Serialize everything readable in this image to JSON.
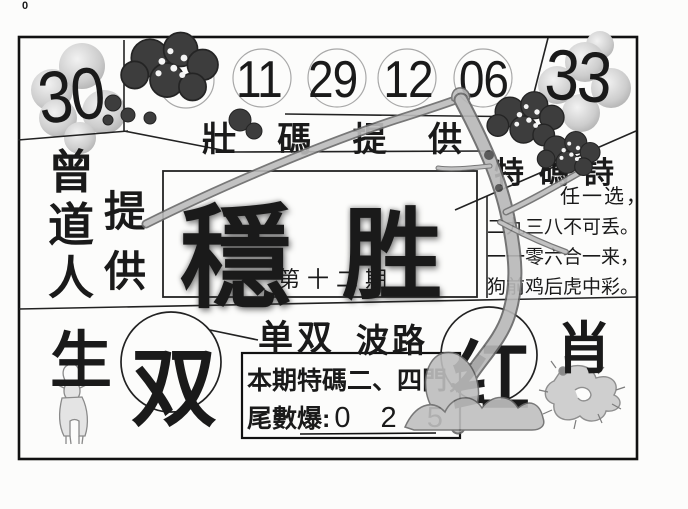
{
  "page": {
    "corner_mark": "0"
  },
  "colors": {
    "ink": "#1a1a1a",
    "branch_fill": "#b8b8b8",
    "branch_outline": "#6a6a6a",
    "blossom": "#3d3d3d",
    "ball_shade": "#c9c9c9",
    "circle_stroke": "#a8a8a8"
  },
  "header": {
    "left_number": "30",
    "right_number": "33",
    "special_numbers": [
      "11",
      "29",
      "12",
      "06"
    ],
    "band_chars": [
      "壯",
      "碼",
      "提",
      "供"
    ]
  },
  "left_panel": {
    "name_chars": [
      "曾",
      "道",
      "人"
    ],
    "provide_chars": [
      "提",
      "供"
    ]
  },
  "center": {
    "title_chars": [
      "穩",
      "胜"
    ],
    "issue_label": "第十二期"
  },
  "right_panel": {
    "title": "特碼詩",
    "lines": [
      "任一选，",
      "二九三八不可丢。",
      "一一零六合一来，",
      "狗前鸡后虎中彩。"
    ]
  },
  "bottom": {
    "life_char": "生",
    "even_char": "双",
    "odd_even_label": "单双",
    "wave_label": "波路",
    "tip_line1": "本期特碼二、四門，",
    "tip_line2_label": "尾數爆:",
    "tip_digits": "0 2 5",
    "red_char": "红",
    "zodiac_char": "肖"
  },
  "illustrations": {
    "top_left": "plum-blossom-cluster",
    "top_right": "plum-blossom-cluster",
    "left_balls": "halftone-ball-cluster",
    "right_balls": "halftone-ball-cluster",
    "tree": "plum-branch-and-trunk",
    "bottom_left_animal": "goat",
    "bottom_right_animal": "dragon"
  }
}
